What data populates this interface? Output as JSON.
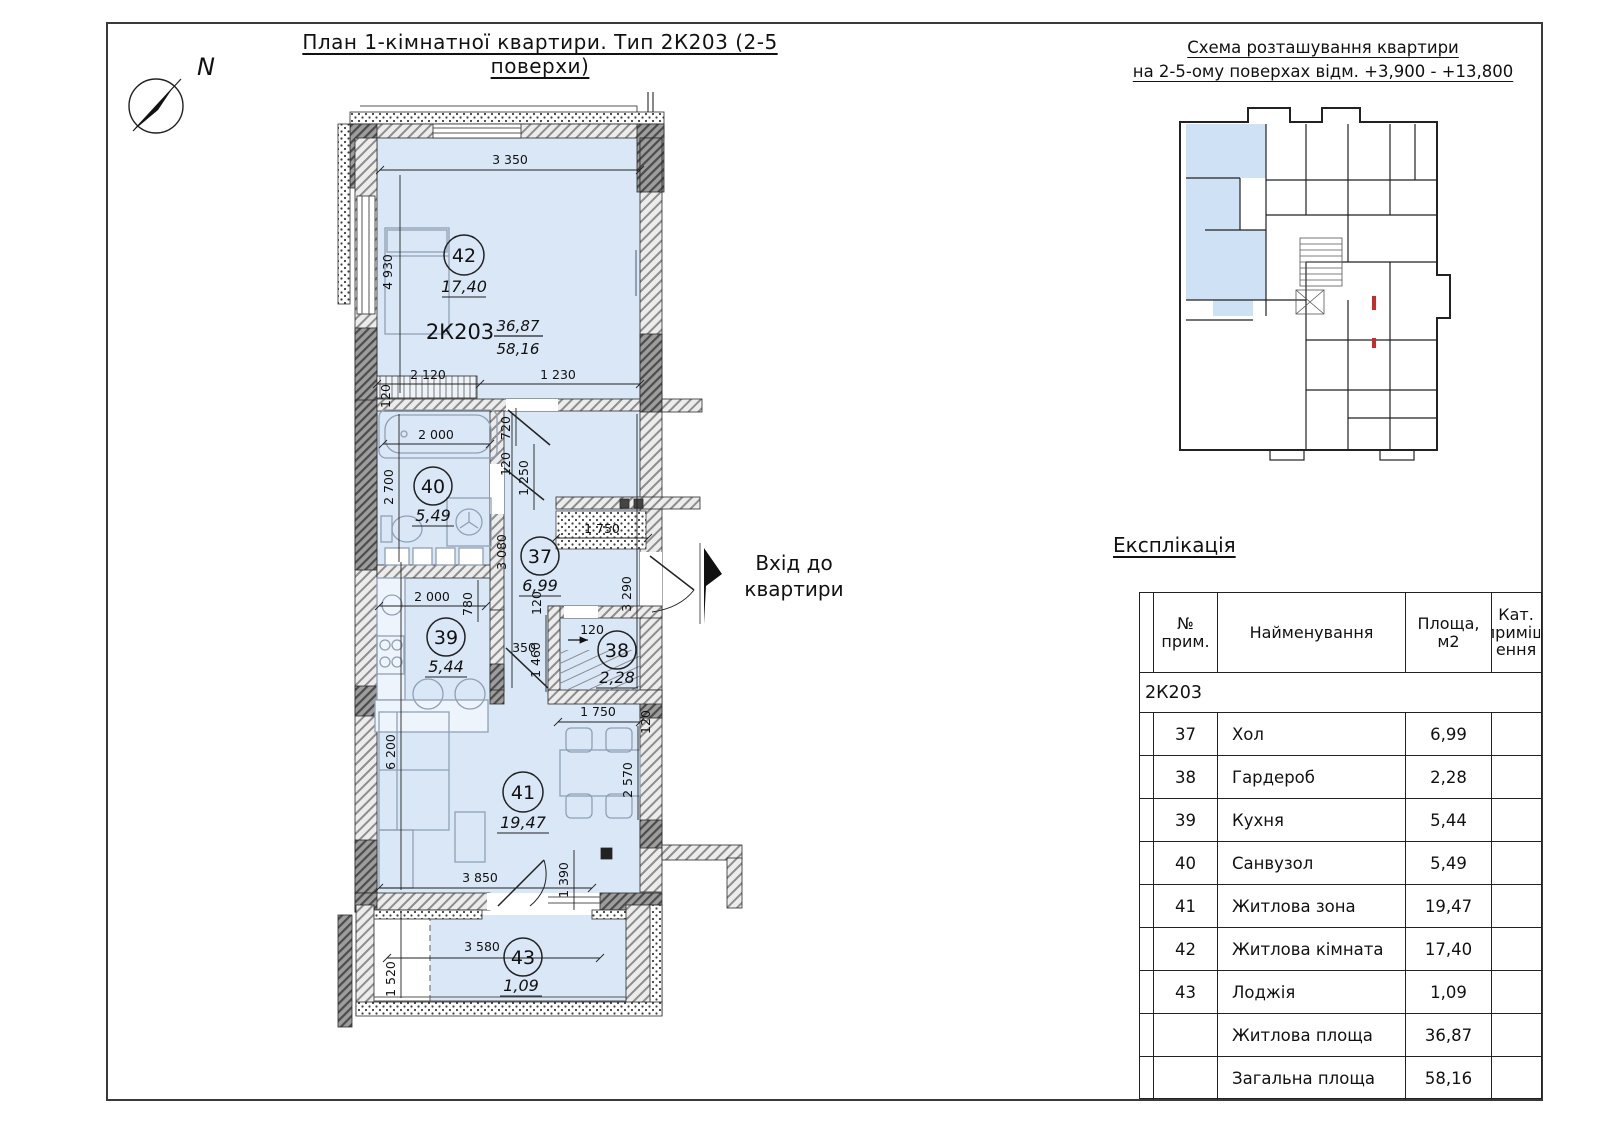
{
  "page": {
    "plan_title": "План 1-кімнатної квартири. Тип 2К203 (2-5 поверхи)",
    "scheme_title_1": "Схема розташування квартири",
    "scheme_title_2": "на 2-5-ому поверхах відм. +3,900 - +13,800",
    "compass_label": "N",
    "entrance_1": "Вхід до",
    "entrance_2": "квартири"
  },
  "plan": {
    "code": "2К203",
    "living_area": "36,87",
    "total_area": "58,16",
    "rooms": {
      "r37": {
        "num": "37",
        "area": "6,99"
      },
      "r38": {
        "num": "38",
        "area": "2,28"
      },
      "r39": {
        "num": "39",
        "area": "5,44"
      },
      "r40": {
        "num": "40",
        "area": "5,49"
      },
      "r41": {
        "num": "41",
        "area": "19,47"
      },
      "r42": {
        "num": "42",
        "area": "17,40"
      },
      "r43": {
        "num": "43",
        "area": "1,09"
      }
    },
    "dims": {
      "w3350": "3 350",
      "h4930": "4 930",
      "w2120": "2 120",
      "w1230": "1 230",
      "t120_ward": "120",
      "w2000_bath": "2 000",
      "h2700": "2 700",
      "h720": "720",
      "t120_hall": "120",
      "h1250": "1 250",
      "h3080": "3 080",
      "w1750_hall": "1 750",
      "t120_hall2": "120",
      "h3290": "3 290",
      "w2000_kit": "2 000",
      "h780": "780",
      "w350": "350",
      "h1460": "1 460",
      "t120_ward2": "120",
      "w1750_liv": "1 750",
      "t120_liv": "120",
      "h2570": "2 570",
      "h6200": "6 200",
      "w3850": "3 850",
      "h1390": "1 390",
      "w3580": "3 580",
      "h1520": "1 520"
    }
  },
  "explication": {
    "title": "Експлікація",
    "col_num": "№\nприм.",
    "col_name": "Найменування",
    "col_area": "Площа,\nм2",
    "col_cat": "Кат.\nприміщ\nення",
    "group": "2К203",
    "rows": [
      {
        "num": "37",
        "name": "Хол",
        "area": "6,99",
        "cat": ""
      },
      {
        "num": "38",
        "name": "Гардероб",
        "area": "2,28",
        "cat": ""
      },
      {
        "num": "39",
        "name": "Кухня",
        "area": "5,44",
        "cat": ""
      },
      {
        "num": "40",
        "name": "Санвузол",
        "area": "5,49",
        "cat": ""
      },
      {
        "num": "41",
        "name": "Житлова зона",
        "area": "19,47",
        "cat": ""
      },
      {
        "num": "42",
        "name": "Житлова кімната",
        "area": "17,40",
        "cat": ""
      },
      {
        "num": "43",
        "name": "Лоджія",
        "area": "1,09",
        "cat": ""
      },
      {
        "num": "",
        "name": "Житлова площа",
        "area": "36,87",
        "cat": ""
      },
      {
        "num": "",
        "name": "Загальна площа",
        "area": "58,16",
        "cat": ""
      }
    ]
  },
  "colors": {
    "room_fill": "#d9e7f6",
    "scheme_fill": "#cfe1f4",
    "wall_dark": "#6b6b6b",
    "accent_red": "#cc2a2a"
  }
}
